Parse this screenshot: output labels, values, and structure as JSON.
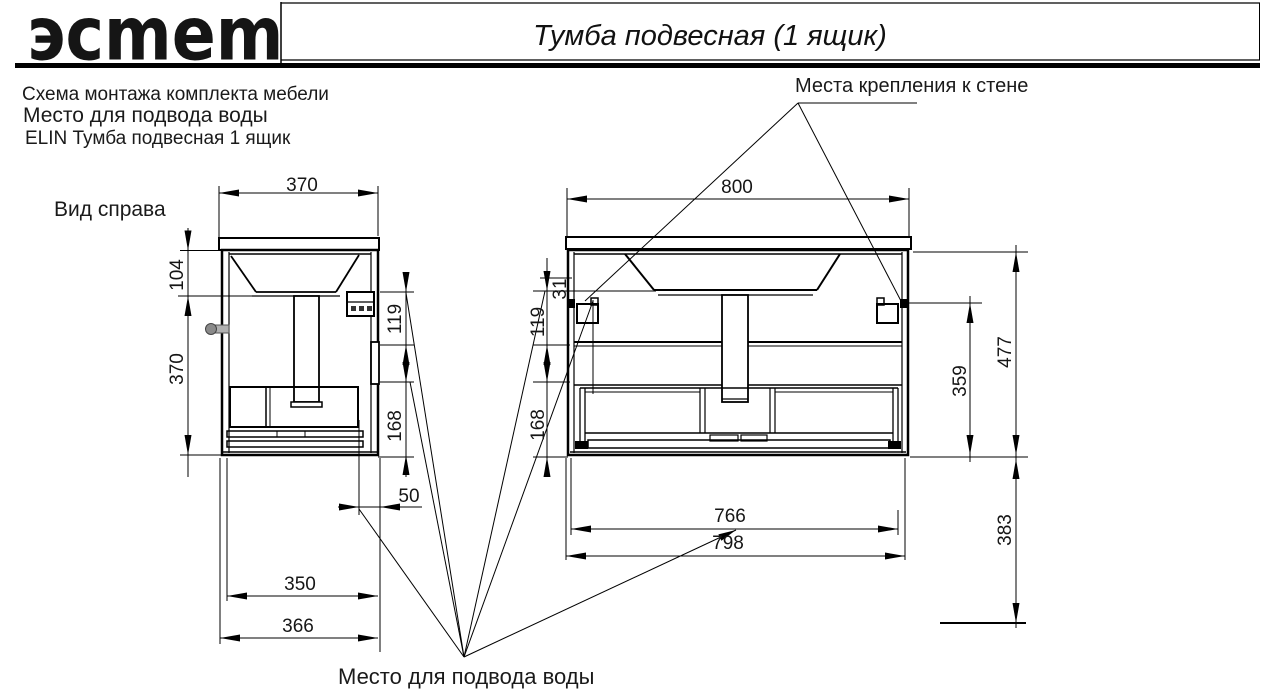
{
  "header": {
    "logo": "эcmem",
    "title": "Тумба подвесная (1 ящик)"
  },
  "notes": {
    "line1": "Схема монтажа комплекта мебели",
    "line2": "Место для подвода воды",
    "line3": "ELIN Тумба подвесная 1 ящик"
  },
  "labels": {
    "wall_mount": "Места крепления к стене",
    "side_view": "Вид справа",
    "water_supply": "Место для подвода воды"
  },
  "side_dims": {
    "top_width": "370",
    "upper_height": "104",
    "body_height": "370",
    "right_upper": "119",
    "right_lower": "168",
    "back_offset": "50",
    "depth_inner": "350",
    "depth_full": "366"
  },
  "front_dims": {
    "top_width": "800",
    "left_tiny": "31",
    "left_upper": "119",
    "left_lower": "168",
    "inner_height": "359",
    "total_height": "477",
    "floor_gap": "383",
    "bottom_inner": "766",
    "bottom_full": "798"
  },
  "colors": {
    "line": "#000000",
    "text": "#1a1a1a"
  }
}
